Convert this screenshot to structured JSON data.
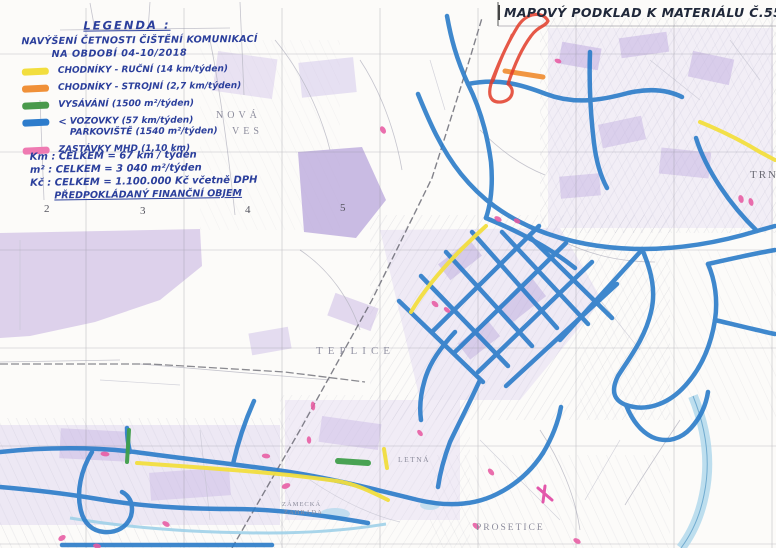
{
  "title": "MAPOVÝ PODKLAD K MATERIÁLU Č.55",
  "ink_color": "#2b3f9c",
  "legend": {
    "heading": "LEGENDA :",
    "subheading1": "NAVÝŠENÍ ČETNOSTI ČIŠTĚNÍ KOMUNIKACÍ",
    "subheading2": "NA OBDOBÍ 04-10/2018",
    "items": [
      {
        "name": "chodniky-rucni",
        "color": "#f2de3e",
        "label": "CHODNÍKY - RUČNÍ (14 km/týden)"
      },
      {
        "name": "chodniky-strojni",
        "color": "#f09038",
        "label": "CHODNÍKY - STROJNÍ (2,7 km/týden)"
      },
      {
        "name": "vysavani",
        "color": "#4a9a4c",
        "label": "VYSÁVÁNÍ (1500 m²/týden)"
      },
      {
        "name": "vozovky-parkoviste",
        "color": "#2d7ccc",
        "arrow": "<",
        "label": "VOZOVKY (57 km/týden)",
        "label2": "PARKOVIŠTĚ (1540 m²/týden)"
      },
      {
        "name": "zastavky-mhd",
        "color": "#ef7ab2",
        "label": "ZASTÁVKY MHD (1,10 km)"
      }
    ],
    "totals": [
      "Km : CELKEM = 67 km / týden",
      "m² : CELKEM = 3 040 m²/týden",
      "Kč : CELKEM = 1.100.000 Kč včetně DPH"
    ],
    "totals_note": "PŘEDPOKLÁDANÝ FINANČNÍ OBJEM"
  },
  "map": {
    "labels": [
      {
        "text": "NOVÁ"
      },
      {
        "text": "VES"
      },
      {
        "text": "TEPLICE"
      },
      {
        "text": "TRN"
      },
      {
        "text": "PROSETICE"
      },
      {
        "text": "LETNÁ"
      },
      {
        "text": "ZÁMECKÁ"
      },
      {
        "text": "ZAHRADA"
      }
    ],
    "grid_numbers": [
      "2",
      "3",
      "4",
      "5"
    ],
    "colors": {
      "route_blue": "#2b7cc9",
      "route_yellow": "#f2de3e",
      "route_orange": "#f09038",
      "route_green": "#3f9e4a",
      "stop_pink": "#e75ba2",
      "annotation_red": "#e23b28",
      "urban_lavender": "#cdbfe8",
      "water_cyan": "#9fd0e8"
    }
  }
}
